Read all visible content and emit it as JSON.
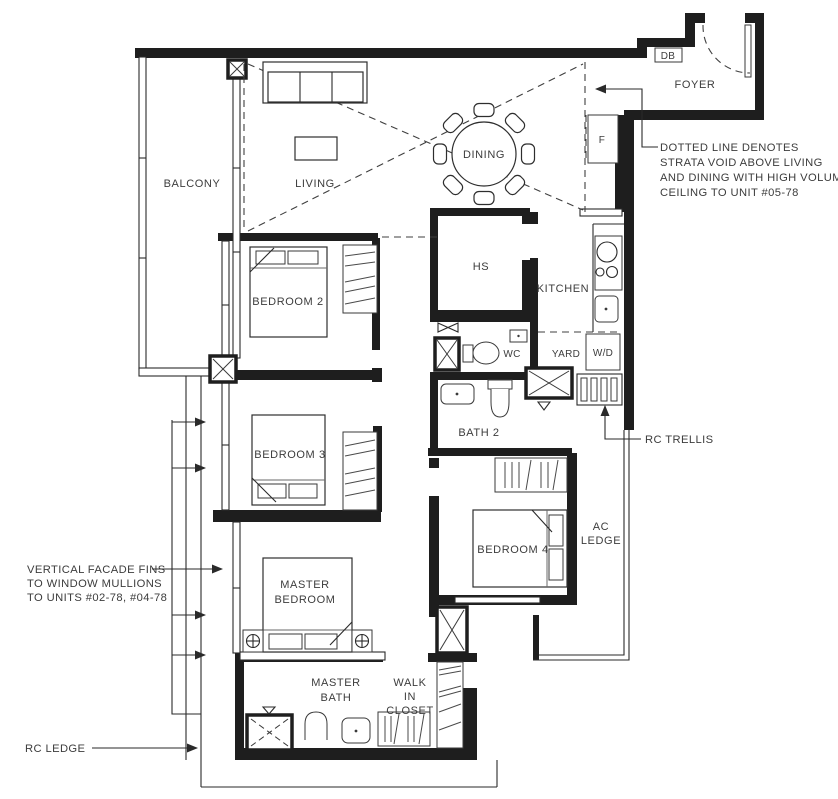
{
  "rooms": {
    "balcony": "BALCONY",
    "living": "LIVING",
    "dining": "DINING",
    "foyer": "FOYER",
    "kitchen": "KITCHEN",
    "yard": "YARD",
    "wc": "WC",
    "hs": "HS",
    "bedroom2": "BEDROOM 2",
    "bedroom3": "BEDROOM 3",
    "bedroom4": "BEDROOM 4",
    "bath2": "BATH 2",
    "master_bedroom_line1": "MASTER",
    "master_bedroom_line2": "BEDROOM",
    "master_bath_line1": "MASTER",
    "master_bath_line2": "BATH",
    "walk_in_closet_line1": "WALK",
    "walk_in_closet_line2": "IN",
    "walk_in_closet_line3": "CLOSET",
    "ac_ledge_line1": "AC",
    "ac_ledge_line2": "LEDGE"
  },
  "fixtures": {
    "db": "DB",
    "fridge": "F",
    "washer_dryer": "W/D"
  },
  "annotations": {
    "strata_void_line1": "DOTTED LINE DENOTES",
    "strata_void_line2": "STRATA VOID ABOVE LIVING",
    "strata_void_line3": "AND DINING WITH HIGH VOLUME",
    "strata_void_line4": "CEILING TO UNIT #05-78",
    "facade_fins_line1": "VERTICAL FACADE FINS",
    "facade_fins_line2": "TO WINDOW MULLIONS",
    "facade_fins_line3": "TO UNITS #02-78, #04-78",
    "rc_trellis": "RC TRELLIS",
    "rc_ledge": "RC LEDGE"
  },
  "colors": {
    "wall": "#1e1e1e",
    "label": "#3c3c3c",
    "background": "#ffffff"
  }
}
